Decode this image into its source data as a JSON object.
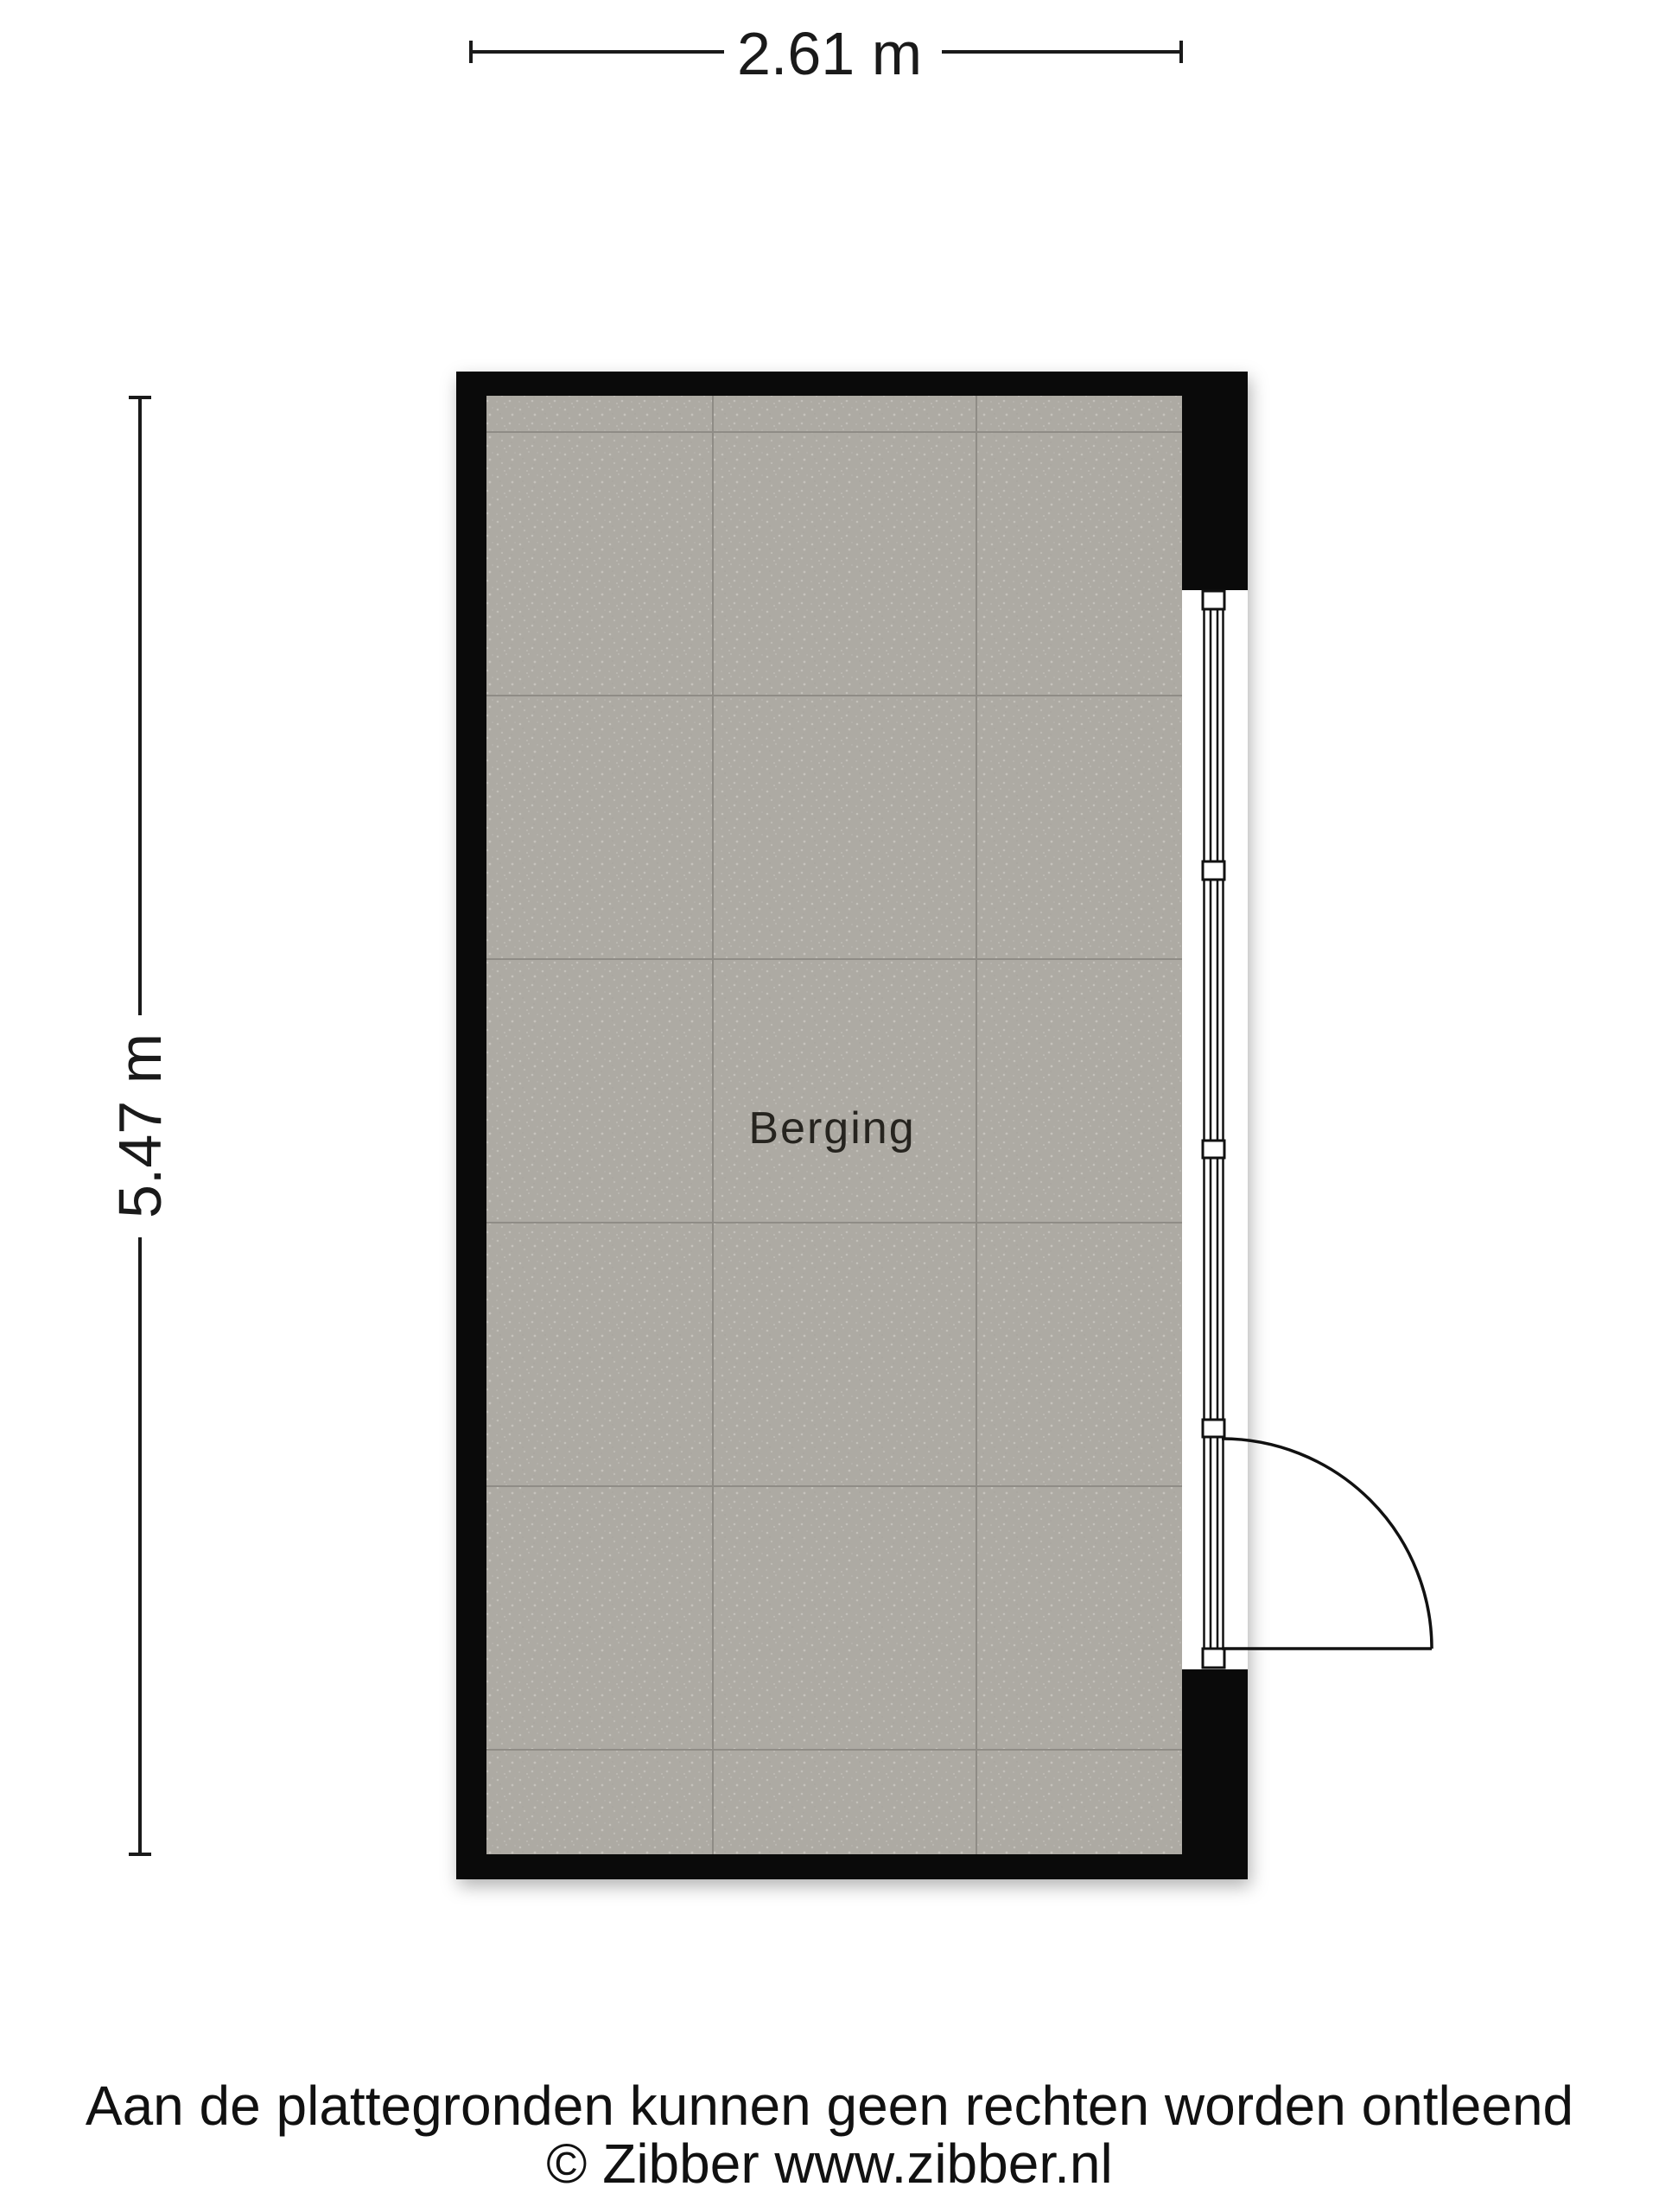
{
  "plan": {
    "type": "floor-plan",
    "room": {
      "label": "Berging"
    },
    "dimensions": {
      "top": {
        "label": "2.61 m"
      },
      "left": {
        "label": "5.47 m"
      }
    },
    "features": {
      "door": "right wall, hinged, swings outward to lower right",
      "window_frame": "glazed frame along right wall with mullion blocks",
      "floor": "gray tiles, approx 1 m grid"
    }
  },
  "footer": {
    "disclaimer": "Aan de plattegronden kunnen geen rechten worden ontleend",
    "copyright": "© Zibber www.zibber.nl"
  },
  "colors": {
    "background": "#ffffff",
    "wall": "#0a0a0a",
    "floor": "#adaaa3",
    "tile_line": "#8f8c86",
    "frame_line": "#111111",
    "dimension_line": "#1a1a1a",
    "text": "#1a1a1a"
  }
}
